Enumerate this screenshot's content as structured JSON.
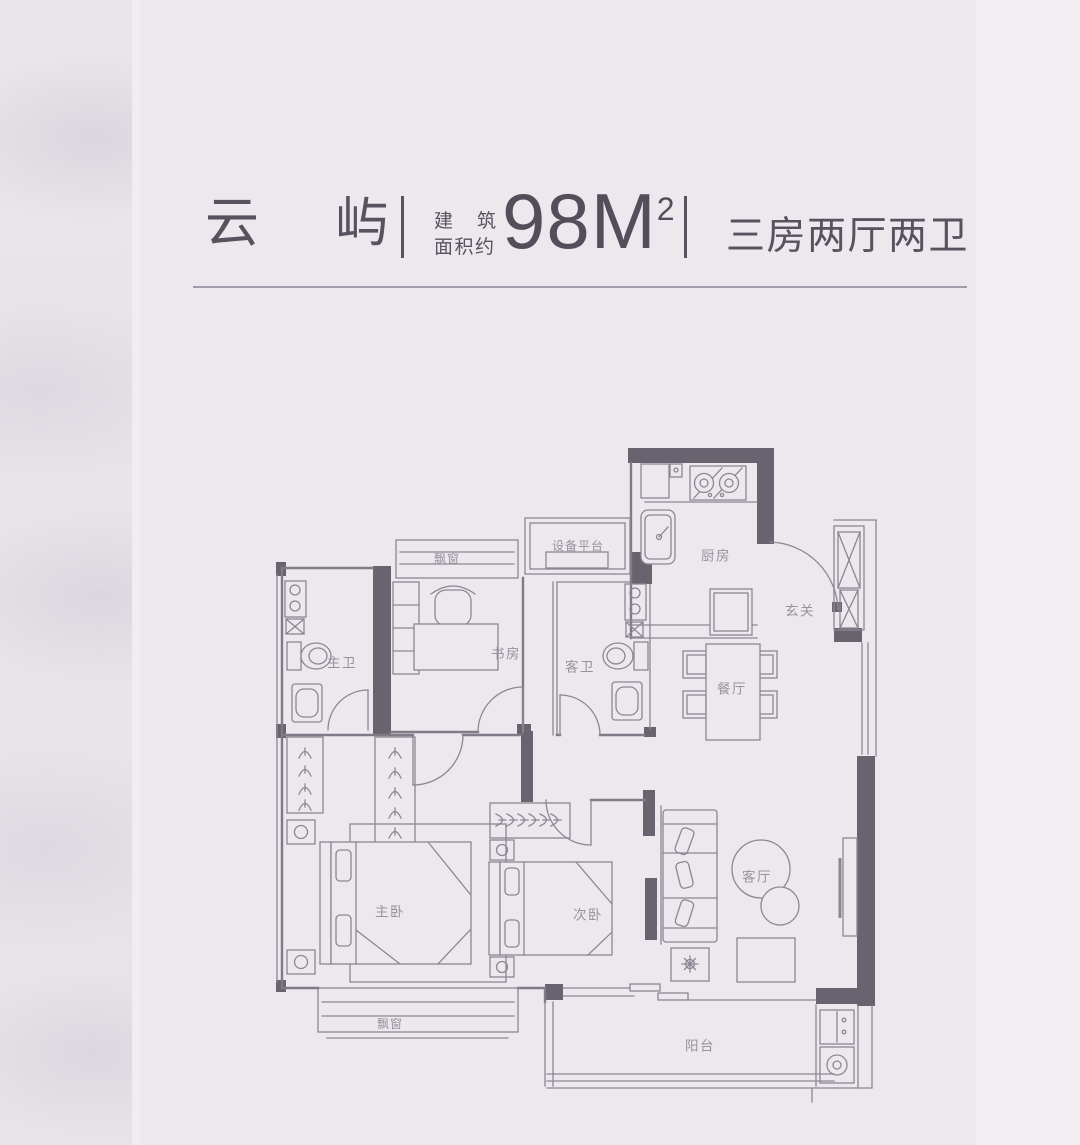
{
  "page": {
    "background": "#ece9ee",
    "left_strip_color": "#e9e5ea",
    "right_strip_color": "#f2eff3"
  },
  "header": {
    "title": "云屿",
    "area_label_top": "建筑",
    "area_label_bottom": "面积约",
    "area_value": "98",
    "area_unit": "M",
    "area_superscript": "2",
    "layout_spec": "三房两厅两卫",
    "text_color": "#57525e"
  },
  "floorplan": {
    "wall_color": "#68636e",
    "line_color": "#8b8793",
    "label_color": "#97929d",
    "labels": {
      "bay_window_top": "飘窗",
      "equipment_platform": "设备平台",
      "kitchen": "厨房",
      "entry": "玄关",
      "study": "书房",
      "guest_bath": "客卫",
      "master_bath": "主卫",
      "dining": "餐厅",
      "master_bedroom": "主卧",
      "second_bedroom": "次卧",
      "living_room": "客厅",
      "bay_window_bottom": "飘窗",
      "balcony": "阳台"
    }
  }
}
